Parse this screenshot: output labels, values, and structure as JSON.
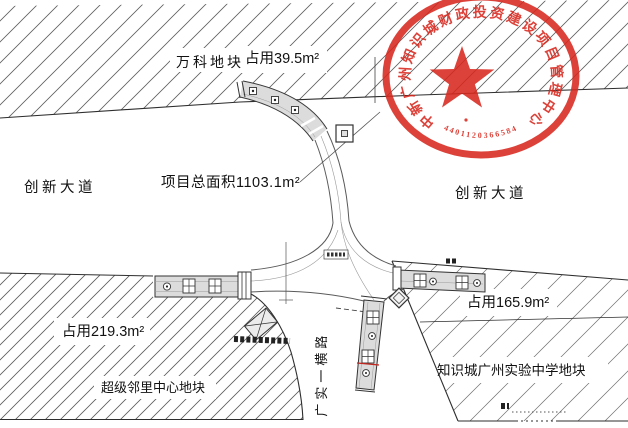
{
  "drawing": {
    "labels": {
      "wanke_parcel": "万科地块",
      "occupy_top": "占用39.5m²",
      "avenue_left": "创新大道",
      "avenue_right": "创新大道",
      "project_total_area": "项目总面积1103.1m²",
      "occupy_left": "占用219.3m²",
      "super_neighborhood_parcel": "超级邻里中心地块",
      "occupy_right": "占用165.9m²",
      "school_parcel": "知识城广州实验中学地块",
      "vertical_road": "广实一横路"
    },
    "colors": {
      "line": "#333333",
      "corridor_fill": "#dcdcdc",
      "hatch": "#5c5c5c",
      "accent_red_line": "#c4271f"
    }
  },
  "seal": {
    "arc_text": "中新广州知识城财政投资建设项目管理中心",
    "serial_number": "4401120366584",
    "color": "#d8281e"
  }
}
